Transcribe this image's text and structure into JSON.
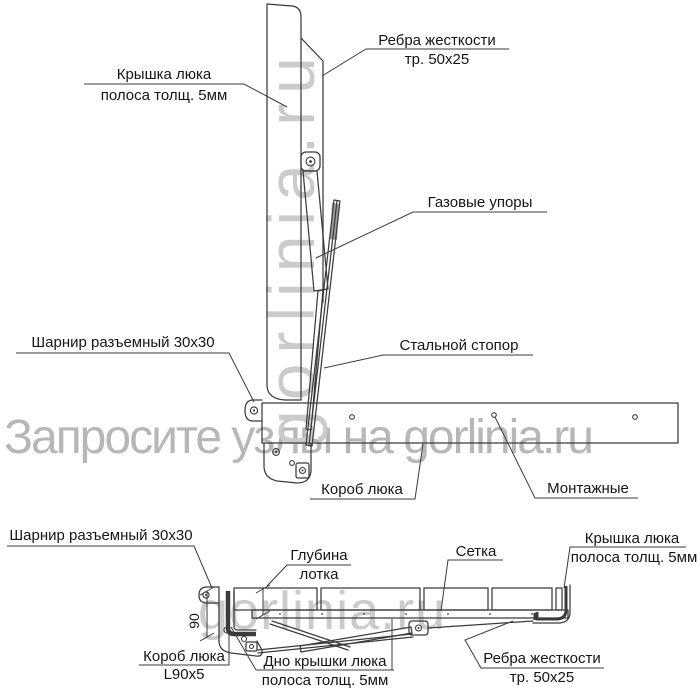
{
  "watermarks": {
    "main": "Запросите узлы на gorlinia.ru",
    "vertical": "gorlinia.ru",
    "bottom": "gorlinia.ru"
  },
  "colors": {
    "line": "#3b3b3b",
    "label": "#151515",
    "watermark_main": "#b7b7b7",
    "watermark_small": "#cbcbcb"
  },
  "top_view": {
    "labels": {
      "ribs": {
        "line1": "Ребра жесткости",
        "line2": "тр. 50x25"
      },
      "cover": {
        "line1": "Крышка люка",
        "line2": "полоса толщ. 5мм"
      },
      "gas_struts": {
        "line1": "Газовые упоры"
      },
      "hinge": {
        "line1": "Шарнир разъемный 30x30"
      },
      "stopper": {
        "line1": "Стальной стопор"
      },
      "box": {
        "line1": "Короб люка"
      },
      "mounting": {
        "line1": "Монтажные"
      }
    }
  },
  "bottom_view": {
    "labels": {
      "hinge": {
        "line1": "Шарнир разъемный 30x30"
      },
      "depth": {
        "line1": "Глубина",
        "line2": "лотка"
      },
      "mesh": {
        "line1": "Сетка"
      },
      "cover": {
        "line1": "Крышка люка",
        "line2": "полоса толщ. 5мм"
      },
      "box": {
        "line1": "Короб люка",
        "line2": "L90x5"
      },
      "bottom_plate": {
        "line1": "Дно крышки люка",
        "line2": "полоса толщ. 5мм"
      },
      "ribs": {
        "line1": "Ребра жесткости",
        "line2": "тр. 50x25"
      },
      "dim_90": {
        "value": "90"
      }
    }
  }
}
